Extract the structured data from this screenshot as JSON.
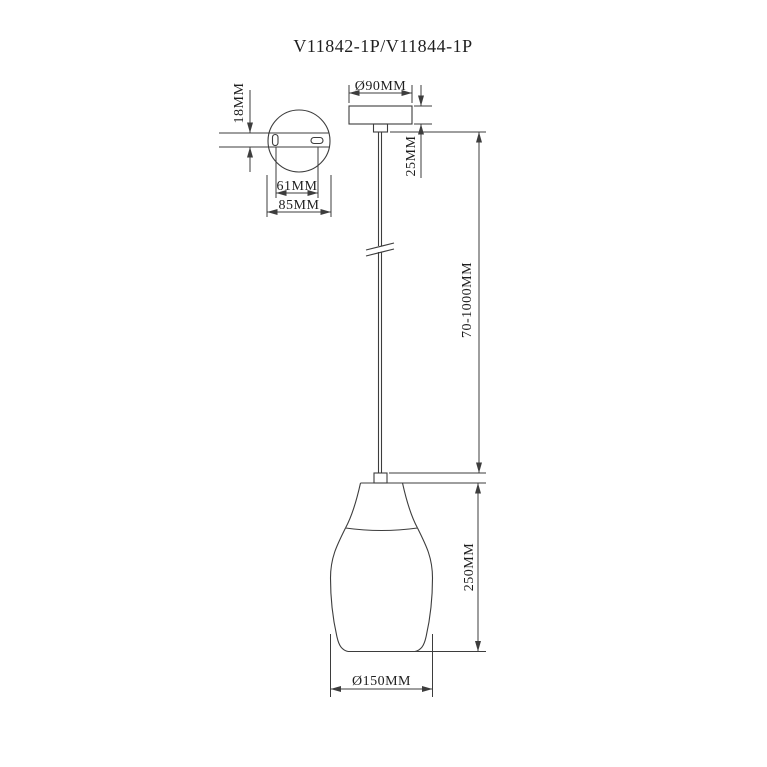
{
  "title": "V11842-1P/V11844-1P",
  "drawing": {
    "ceiling_plate_detail": {
      "height_dim": "18MM",
      "hole_spacing_dim": "61MM",
      "plate_diameter_dim": "85MM"
    },
    "canopy": {
      "diameter_dim": "Ø90MM",
      "height_dim": "25MM"
    },
    "cable": {
      "length_dim": "70-1000MM"
    },
    "shade": {
      "height_dim": "250MM",
      "diameter_dim": "Ø150MM"
    }
  },
  "colors": {
    "line": "#3d3d3d",
    "text": "#1f1f1f",
    "background": "#ffffff"
  }
}
